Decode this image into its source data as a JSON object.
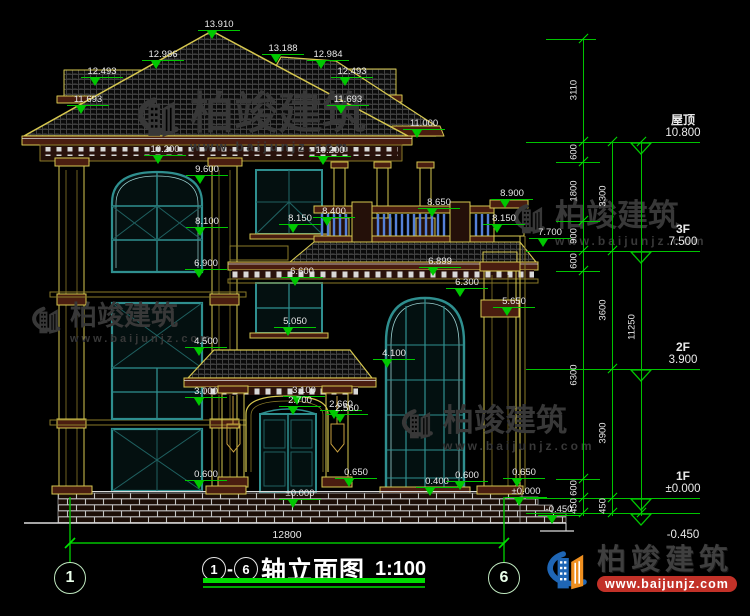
{
  "title": {
    "axis_start": "1",
    "dash": "-",
    "axis_end": "6",
    "name": "轴立面图",
    "scale": "1:100"
  },
  "axes": {
    "left_bubble": "1",
    "right_bubble": "6",
    "bottom_dim": "12800"
  },
  "brand": {
    "name": "柏竣建筑",
    "url": "www.baijunjz.com"
  },
  "colors": {
    "dim_green": "#00c400",
    "line_yellow": "#d6c74f",
    "window_teal": "#2f8f8f",
    "brick_maroon": "#4a1d10",
    "baluster_blue": "#5580d8",
    "brand_blue": "#1f66b5",
    "brand_orange": "#ef8f1f",
    "banner_red": "#c23128"
  },
  "elevation_labels": [
    {
      "t": "13.910",
      "x": 219,
      "y": 19
    },
    {
      "t": "12.986",
      "x": 163,
      "y": 49
    },
    {
      "t": "13.188",
      "x": 283,
      "y": 43
    },
    {
      "t": "12.984",
      "x": 328,
      "y": 49
    },
    {
      "t": "12.493",
      "x": 102,
      "y": 66
    },
    {
      "t": "12.493",
      "x": 352,
      "y": 66
    },
    {
      "t": "11.693",
      "x": 88,
      "y": 94
    },
    {
      "t": "11.693",
      "x": 348,
      "y": 94
    },
    {
      "t": "11.000",
      "x": 424,
      "y": 118
    },
    {
      "t": "10.200",
      "x": 165,
      "y": 144
    },
    {
      "t": "10.200",
      "x": 330,
      "y": 145
    },
    {
      "t": "9.600",
      "x": 207,
      "y": 164
    },
    {
      "t": "8.900",
      "x": 512,
      "y": 188
    },
    {
      "t": "8.650",
      "x": 439,
      "y": 197
    },
    {
      "t": "8.400",
      "x": 334,
      "y": 206
    },
    {
      "t": "8.150",
      "x": 300,
      "y": 213
    },
    {
      "t": "8.150",
      "x": 504,
      "y": 213
    },
    {
      "t": "8.100",
      "x": 207,
      "y": 216
    },
    {
      "t": "7.700",
      "x": 550,
      "y": 227
    },
    {
      "t": "6.899",
      "x": 440,
      "y": 256
    },
    {
      "t": "6.900",
      "x": 206,
      "y": 258
    },
    {
      "t": "6.600",
      "x": 302,
      "y": 266
    },
    {
      "t": "6.300",
      "x": 467,
      "y": 277
    },
    {
      "t": "5.650",
      "x": 514,
      "y": 296
    },
    {
      "t": "5.050",
      "x": 295,
      "y": 316
    },
    {
      "t": "4.500",
      "x": 206,
      "y": 336
    },
    {
      "t": "4.100",
      "x": 394,
      "y": 348
    },
    {
      "t": "3.100",
      "x": 304,
      "y": 385
    },
    {
      "t": "3.000",
      "x": 206,
      "y": 386
    },
    {
      "t": "2.700",
      "x": 300,
      "y": 395
    },
    {
      "t": "2.660",
      "x": 341,
      "y": 399
    },
    {
      "t": "2.560",
      "x": 347,
      "y": 403
    },
    {
      "t": "0.600",
      "x": 206,
      "y": 469
    },
    {
      "t": "0.650",
      "x": 356,
      "y": 467
    },
    {
      "t": "0.400",
      "x": 437,
      "y": 476
    },
    {
      "t": "0.600",
      "x": 467,
      "y": 470
    },
    {
      "t": "0.650",
      "x": 524,
      "y": 467
    },
    {
      "t": "±0.000",
      "x": 300,
      "y": 488
    },
    {
      "t": "±0.000",
      "x": 526,
      "y": 486
    },
    {
      "t": "-0.450",
      "x": 559,
      "y": 504
    }
  ],
  "dim_chains": [
    {
      "x": 583,
      "top": 39,
      "bottom": 516,
      "ticks": [
        39,
        142,
        162,
        221,
        251,
        271,
        479,
        498,
        513
      ],
      "segments": [
        {
          "label": "3110",
          "mid": 90
        },
        {
          "label": "600",
          "mid": 152
        },
        {
          "label": "1800",
          "mid": 191
        },
        {
          "label": "900",
          "mid": 236
        },
        {
          "label": "600",
          "mid": 261
        },
        {
          "label": "6300",
          "mid": 375
        },
        {
          "label": "600",
          "mid": 488
        },
        {
          "label": "450",
          "mid": 506
        }
      ]
    },
    {
      "x": 612,
      "top": 142,
      "bottom": 516,
      "ticks": [
        142,
        251,
        369,
        498,
        513
      ],
      "segments": [
        {
          "label": "3300",
          "mid": 196
        },
        {
          "label": "3600",
          "mid": 310
        },
        {
          "label": "3900",
          "mid": 433
        },
        {
          "label": "450",
          "mid": 506
        }
      ]
    },
    {
      "x": 641,
      "top": 142,
      "bottom": 516,
      "ticks": [
        142,
        513
      ],
      "segments": [
        {
          "label": "11250",
          "mid": 327
        }
      ]
    }
  ],
  "dim_hlines": [
    {
      "y": 39,
      "x1": 546,
      "x2": 596
    },
    {
      "y": 142,
      "x1": 526,
      "x2": 700
    },
    {
      "y": 162,
      "x1": 556,
      "x2": 600
    },
    {
      "y": 221,
      "x1": 556,
      "x2": 600
    },
    {
      "y": 251,
      "x1": 526,
      "x2": 700
    },
    {
      "y": 271,
      "x1": 556,
      "x2": 600
    },
    {
      "y": 369,
      "x1": 526,
      "x2": 700
    },
    {
      "y": 479,
      "x1": 556,
      "x2": 600
    },
    {
      "y": 498,
      "x1": 526,
      "x2": 700
    },
    {
      "y": 513,
      "x1": 526,
      "x2": 700
    }
  ],
  "level_flags": [
    {
      "name": "屋顶",
      "value": "10.800",
      "y": 142,
      "below": false
    },
    {
      "name": "3F",
      "value": "7.500",
      "y": 251,
      "below": false
    },
    {
      "name": "2F",
      "value": "3.900",
      "y": 369,
      "below": false
    },
    {
      "name": "1F",
      "value": "±0.000",
      "y": 498,
      "below": false
    },
    {
      "name": "",
      "value": "-0.450",
      "y": 513,
      "below": true
    }
  ],
  "watermarks": [
    {
      "x": 126,
      "y": 92,
      "font": 44,
      "url_font": 13,
      "logo": 58,
      "text": "柏竣建筑",
      "url": "www.baijunjz.com"
    },
    {
      "x": 505,
      "y": 200,
      "font": 31,
      "url_font": 12,
      "logo": 44,
      "text": "柏竣建筑",
      "url": "www.baijunjz.com"
    },
    {
      "x": 24,
      "y": 303,
      "font": 27,
      "url_font": 11,
      "logo": 40,
      "text": "柏竣建筑",
      "url": "www.baijunjz.com"
    },
    {
      "x": 393,
      "y": 405,
      "font": 31,
      "url_font": 12,
      "logo": 44,
      "text": "柏竣建筑",
      "url": "www.baijunjz.com"
    }
  ]
}
